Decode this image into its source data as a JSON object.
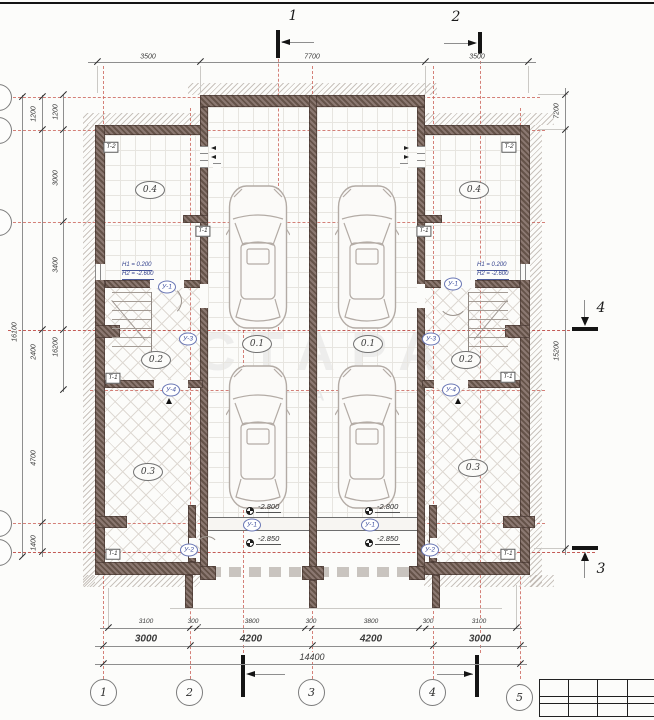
{
  "plan": {
    "watermark": {
      "line1": "СТАРА",
      "line2": "S T A R A"
    },
    "section_markers": {
      "s1": "1",
      "s2": "2",
      "s3": "3",
      "s4": "4"
    },
    "axis_circles": [
      "1",
      "2",
      "3",
      "4",
      "5"
    ],
    "dims": {
      "top": [
        "3500",
        "7700",
        "3500"
      ],
      "left_overall": "16100",
      "left_col2": [
        "1200",
        "2400",
        "4700",
        "1400"
      ],
      "left_col3": [
        "1200",
        "3000",
        "3400",
        "16200"
      ],
      "right": [
        "7200",
        "15200"
      ],
      "bottom_row1": [
        "3100",
        "300",
        "3800",
        "300",
        "3800",
        "300",
        "3100"
      ],
      "bottom_row2": [
        "3000",
        "4200",
        "4200",
        "3000"
      ],
      "bottom_total": "14400"
    },
    "rooms": {
      "r04": "0.4",
      "r01": "0.1",
      "r02": "0.2",
      "r03": "0.3"
    },
    "tags": {
      "t1": "T-1",
      "t2": "T-2"
    },
    "lintels": {
      "u1": "У-1",
      "u2": "У-2",
      "u3": "У-3",
      "u4": "У-4"
    },
    "levels": {
      "upper": "-2.800",
      "lower": "-2.850"
    },
    "notes": {
      "h1": "H1 = 0.200",
      "h2": "H2 = -2.600"
    }
  }
}
